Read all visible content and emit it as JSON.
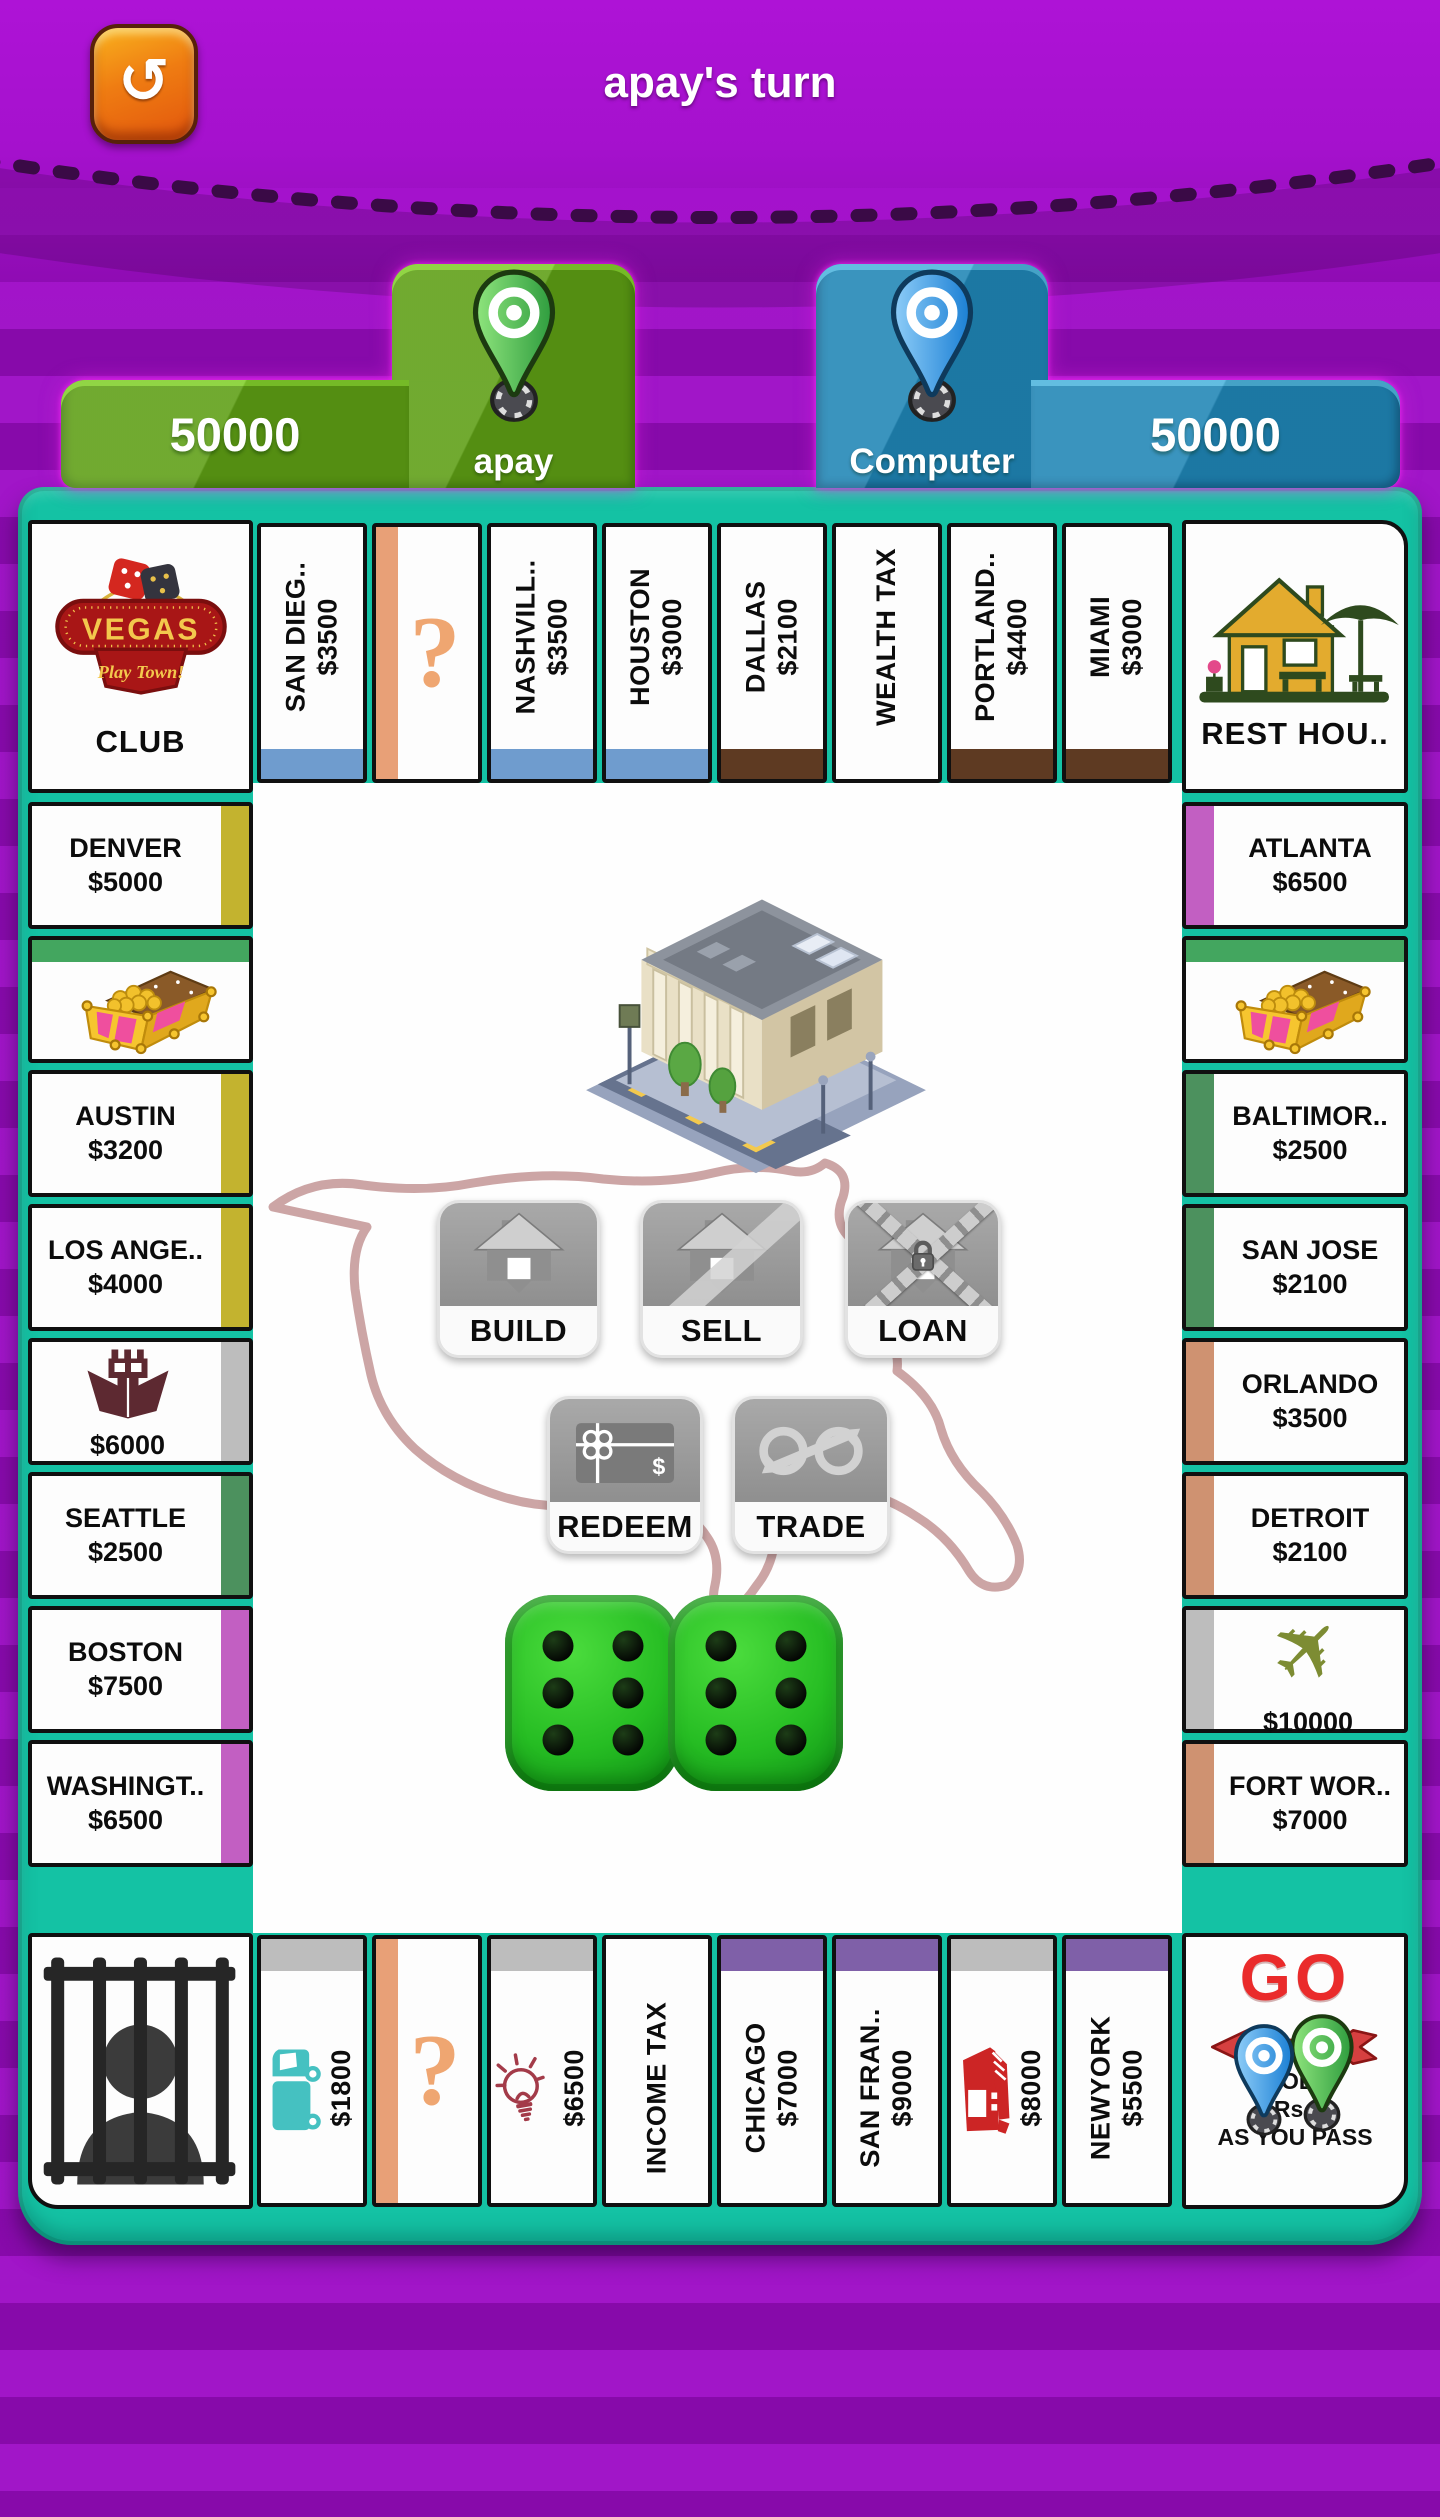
{
  "header": {
    "title": "apay's turn"
  },
  "players": [
    {
      "name": "apay",
      "money": "50000",
      "color": "#5d9e14"
    },
    {
      "name": "Computer",
      "money": "50000",
      "color": "#1f85b5"
    }
  ],
  "board": {
    "corners": {
      "club": {
        "sign_top": "VEGAS",
        "sign_bottom": "Play Town!",
        "label": "CLUB"
      },
      "rest": {
        "label": "REST HOU.."
      },
      "jail": {},
      "go": {
        "go": "GO",
        "line1": "COL..",
        "line2": "Rs..",
        "line3": "AS YOU PASS"
      }
    },
    "top_row": [
      {
        "name": "SAN DIEG..",
        "price": "$3500",
        "band": "blue",
        "type": "prop"
      },
      {
        "type": "chance",
        "symbol": "?"
      },
      {
        "name": "NASHVILL..",
        "price": "$3500",
        "band": "blue",
        "type": "prop"
      },
      {
        "name": "HOUSTON",
        "price": "$3000",
        "band": "blue",
        "type": "prop"
      },
      {
        "name": "DALLAS",
        "price": "$2100",
        "band": "brown",
        "type": "prop"
      },
      {
        "name": "WEALTH TAX",
        "type": "tax"
      },
      {
        "name": "PORTLAND..",
        "price": "$4400",
        "band": "brown",
        "type": "prop"
      },
      {
        "name": "MIAMI",
        "price": "$3000",
        "band": "brown",
        "type": "prop"
      }
    ],
    "right_col": [
      {
        "name": "ATLANTA",
        "price": "$6500",
        "band": "orchid",
        "type": "prop"
      },
      {
        "type": "chest",
        "icon": "treasure-chest-icon"
      },
      {
        "name": "BALTIMOR..",
        "price": "$2500",
        "band": "green",
        "type": "prop"
      },
      {
        "name": "SAN JOSE",
        "price": "$2100",
        "band": "green",
        "type": "prop"
      },
      {
        "name": "ORLANDO",
        "price": "$3500",
        "band": "tan",
        "type": "prop"
      },
      {
        "name": "DETROIT",
        "price": "$2100",
        "band": "tan",
        "type": "prop"
      },
      {
        "type": "util",
        "icon": "airplane-icon",
        "price": "$10000",
        "band": "gray"
      },
      {
        "name": "FORT WOR..",
        "price": "$7000",
        "band": "tan",
        "type": "prop"
      }
    ],
    "bottom_row": [
      {
        "type": "util",
        "icon": "delivery-truck-icon",
        "price": "$1800",
        "band": "gray"
      },
      {
        "type": "chance",
        "symbol": "?"
      },
      {
        "type": "util",
        "icon": "light-bulb-icon",
        "price": "$6500",
        "band": "gray"
      },
      {
        "name": "INCOME TAX",
        "type": "tax"
      },
      {
        "name": "CHICAGO",
        "price": "$7000",
        "band": "purple",
        "type": "prop"
      },
      {
        "name": "SAN FRAN..",
        "price": "$9000",
        "band": "purple",
        "type": "prop"
      },
      {
        "type": "util",
        "icon": "tram-icon",
        "price": "$8000",
        "band": "gray"
      },
      {
        "name": "NEWYORK",
        "price": "$5500",
        "band": "purple",
        "type": "prop"
      }
    ],
    "left_col": [
      {
        "name": "DENVER",
        "price": "$5000",
        "band": "yellow",
        "type": "prop"
      },
      {
        "type": "chest",
        "icon": "treasure-chest-icon"
      },
      {
        "name": "AUSTIN",
        "price": "$3200",
        "band": "yellow",
        "type": "prop"
      },
      {
        "name": "LOS ANGE..",
        "price": "$4000",
        "band": "yellow",
        "type": "prop"
      },
      {
        "type": "util",
        "icon": "cargo-ship-icon",
        "price": "$6000",
        "band": "gray"
      },
      {
        "name": "SEATTLE",
        "price": "$2500",
        "band": "green",
        "type": "prop"
      },
      {
        "name": "BOSTON",
        "price": "$7500",
        "band": "orchid",
        "type": "prop"
      },
      {
        "name": "WASHINGT..",
        "price": "$6500",
        "band": "orchid",
        "type": "prop"
      }
    ],
    "buttons": [
      {
        "label": "BUILD",
        "icon": "build-house-icon"
      },
      {
        "label": "SELL",
        "icon": "sell-house-icon"
      },
      {
        "label": "LOAN",
        "icon": "loan-house-icon"
      },
      {
        "label": "REDEEM",
        "icon": "redeem-card-icon"
      },
      {
        "label": "TRADE",
        "icon": "trade-arrows-icon"
      }
    ],
    "dice": {
      "values": [
        6,
        6
      ]
    }
  },
  "colors": {
    "blue": "#6f9cce",
    "brown": "#5e3a22",
    "yellow": "#c3b32f",
    "gray": "#bdbdbd",
    "green": "#4c915e",
    "orchid": "#c25fc2",
    "tan": "#cf9271",
    "purple": "#7f60a8",
    "chance_bar": "#e8a077",
    "chance_text": "#efa671",
    "chest_band": "#43a65f",
    "board_teal": "#14c2a4",
    "panel_green": "#5d9e14",
    "panel_blue": "#1f85b5",
    "dice_green": "#26bd23",
    "go_red": "#ea2b2b",
    "bg_purple": "#9d0cc6",
    "title_highlight": "#2abfa4",
    "ship_icon": "#5d2931",
    "plane_icon": "#7d8c33",
    "truck_icon": "#45c1c1",
    "bulb_icon": "#a33b49",
    "tram_icon": "#cc2525"
  }
}
